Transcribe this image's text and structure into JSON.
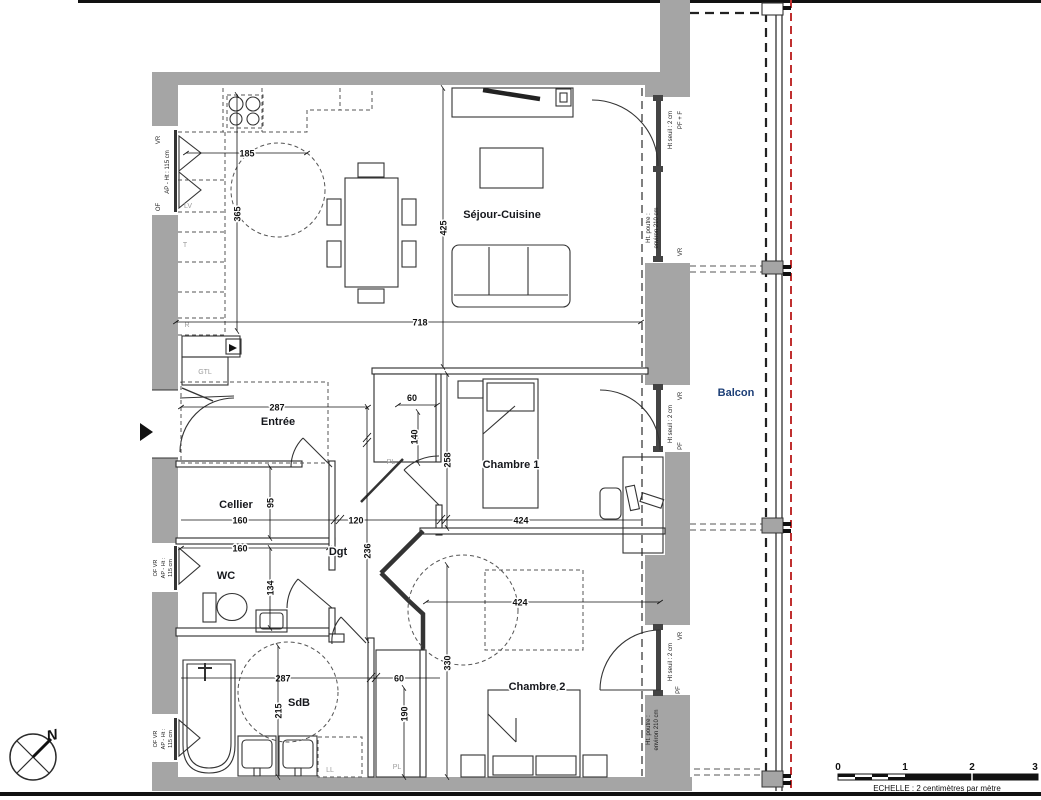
{
  "rooms": {
    "sejour": "Séjour-Cuisine",
    "entree": "Entrée",
    "cellier": "Cellier",
    "wc": "WC",
    "dgt": "Dgt",
    "sdb": "SdB",
    "chambre1": "Chambre 1",
    "chambre2": "Chambre 2",
    "balcon": "Balcon"
  },
  "dims": {
    "sejour_w": "718",
    "sejour_h": "425",
    "kitchen_w": "185",
    "kitchen_h": "365",
    "entree_w": "287",
    "cellier_w": "160",
    "cellier_h": "95",
    "wc_w": "160",
    "wc_h": "134",
    "dgt_w": "120",
    "dgt_h": "236",
    "sdb_w": "287",
    "sdb_h": "215",
    "sdb_pl_w": "60",
    "sdb_pl_h": "190",
    "ch1_w": "424",
    "ch1_h": "258",
    "ch1_pl_w": "60",
    "ch1_pl_h": "140",
    "ch2_w": "424",
    "ch2_h": "330"
  },
  "annotations": {
    "of": "OF",
    "vr": "VR",
    "ap_ht": "AP - Ht : 115 cm",
    "of_vr": "OF  VR",
    "ap": "AP - Ht :",
    "cm115": "115 cm",
    "ht_seuil": "Ht seuil : 2 cm",
    "pf_f": "PF + F",
    "pf": "PF",
    "poutre1": "Ht. poutre :",
    "poutre2": "environ 210 cm"
  },
  "appliances": {
    "gtl": "GTL",
    "lv": "LV",
    "t": "T",
    "r": "R",
    "ll": "LL",
    "pl": "PL"
  },
  "compass": {
    "north": "N"
  },
  "scalebar": {
    "t0": "0",
    "t1": "1",
    "t2": "2",
    "t3": "3",
    "caption": "ECHELLE : 2 centimètres par mètre"
  },
  "colors": {
    "wall": "#a5a5a5",
    "line": "#2b2b2b",
    "dim": "#111111",
    "muted": "#9c9c9c",
    "red": "#c03030",
    "balcon_label": "#1d3f77",
    "room_label": "#15171c"
  }
}
